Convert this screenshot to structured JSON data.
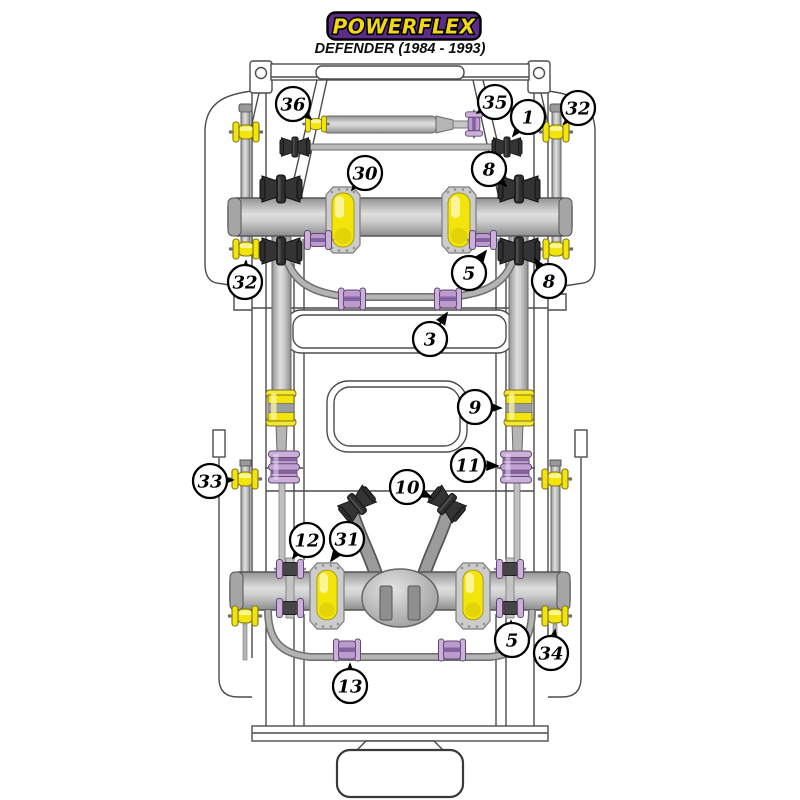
{
  "brand": {
    "logo_text": "POWERFLEX",
    "subtitle": "DEFENDER (1984 - 1993)",
    "logo_bg_color": "#5b2d87",
    "logo_text_color": "#f2d713",
    "logo_border_color": "#000000"
  },
  "legend_colors": {
    "polyurethane_yellow": "#f3e50c",
    "polyurethane_purple": "#c2a1d2",
    "rubber_black": "#2e2e2e",
    "chassis_metal_gray": "#b5b5b5"
  },
  "callouts": [
    {
      "label": "36",
      "x": 293,
      "y": 104,
      "tx": 311,
      "ty": 119
    },
    {
      "label": "35",
      "x": 495,
      "y": 102,
      "tx": 477,
      "ty": 113
    },
    {
      "label": "1",
      "x": 528,
      "y": 117,
      "tx": 513,
      "ty": 136
    },
    {
      "label": "32",
      "x": 578,
      "y": 108,
      "tx": 564,
      "ty": 124
    },
    {
      "label": "30",
      "x": 365,
      "y": 173,
      "tx": 352,
      "ty": 190
    },
    {
      "label": "8",
      "x": 489,
      "y": 169,
      "tx": 506,
      "ty": 186
    },
    {
      "label": "5",
      "x": 469,
      "y": 273,
      "tx": 486,
      "ty": 251
    },
    {
      "label": "32",
      "x": 245,
      "y": 282,
      "tx": 246,
      "ty": 261
    },
    {
      "label": "8",
      "x": 549,
      "y": 281,
      "tx": 535,
      "ty": 259
    },
    {
      "label": "3",
      "x": 430,
      "y": 339,
      "tx": 447,
      "ty": 313
    },
    {
      "label": "9",
      "x": 475,
      "y": 407,
      "tx": 501,
      "ty": 408
    },
    {
      "label": "11",
      "x": 468,
      "y": 465,
      "tx": 498,
      "ty": 466
    },
    {
      "label": "33",
      "x": 210,
      "y": 481,
      "tx": 233,
      "ty": 480
    },
    {
      "label": "10",
      "x": 407,
      "y": 487,
      "tx": 431,
      "ty": 497
    },
    {
      "label": "12",
      "x": 307,
      "y": 540,
      "tx": 293,
      "ty": 558
    },
    {
      "label": "31",
      "x": 347,
      "y": 539,
      "tx": 331,
      "ty": 561
    },
    {
      "label": "5",
      "x": 512,
      "y": 640,
      "tx": 511,
      "ty": 621
    },
    {
      "label": "34",
      "x": 551,
      "y": 653,
      "tx": 555,
      "ty": 630
    },
    {
      "label": "13",
      "x": 350,
      "y": 686,
      "tx": 350,
      "ty": 664
    }
  ]
}
